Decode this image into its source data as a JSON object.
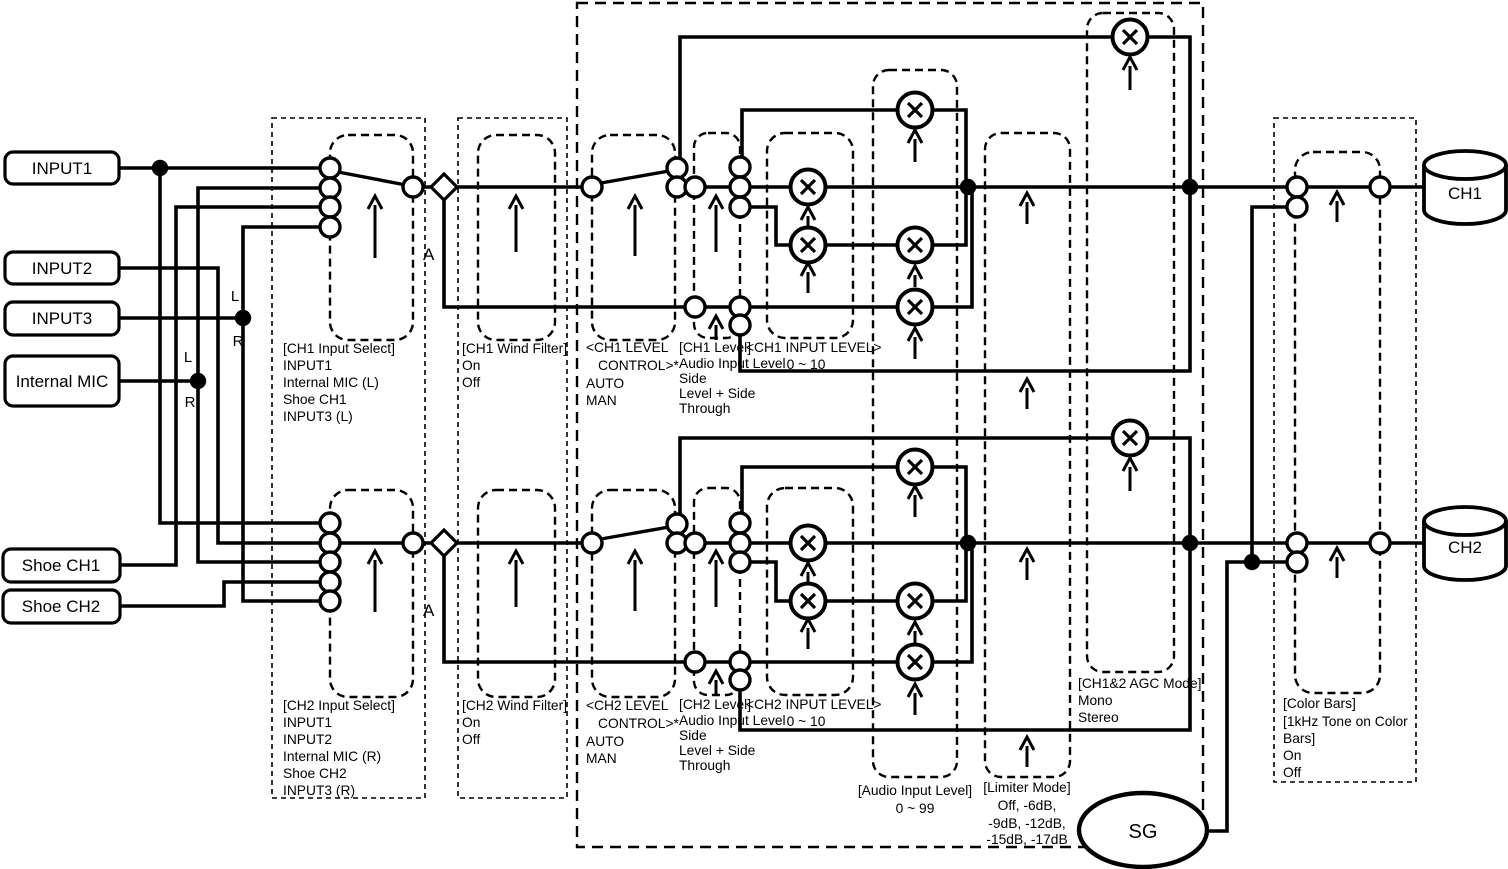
{
  "inputs": {
    "input1": "INPUT1",
    "input2": "INPUT2",
    "input3": "INPUT3",
    "internal_mic": "Internal MIC",
    "shoe_ch1": "Shoe CH1",
    "shoe_ch2": "Shoe CH2"
  },
  "outputs": {
    "ch1": "CH1",
    "ch2": "CH2",
    "sg": "SG"
  },
  "annotations": {
    "a": "A",
    "l": "L",
    "r": "R"
  },
  "blocks": {
    "ch1_input_select": [
      "[CH1 Input Select]",
      "INPUT1",
      "Internal MIC (L)",
      "Shoe CH1",
      "INPUT3 (L)"
    ],
    "ch1_wind_filter": [
      "[CH1 Wind Filter]",
      "On",
      "Off"
    ],
    "ch1_level_control": [
      "<CH1 LEVEL",
      "CONTROL>*",
      "AUTO",
      "MAN"
    ],
    "ch1_level": [
      "[CH1 Level]",
      "Audio Input Level",
      "Side",
      "Level + Side",
      "Through"
    ],
    "ch1_input_level": [
      "<CH1 INPUT LEVEL>",
      "0 ~ 10"
    ],
    "ch2_input_select": [
      "[CH2 Input Select]",
      "INPUT1",
      "INPUT2",
      "Internal MIC (R)",
      "Shoe CH2",
      "INPUT3 (R)"
    ],
    "ch2_wind_filter": [
      "[CH2 Wind Filter]",
      "On",
      "Off"
    ],
    "ch2_level_control": [
      "<CH2 LEVEL",
      "CONTROL>*",
      "AUTO",
      "MAN"
    ],
    "ch2_level": [
      "[CH2 Level]",
      "Audio Input Level",
      "Side",
      "Level + Side",
      "Through"
    ],
    "ch2_input_level": [
      "<CH2 INPUT LEVEL>",
      "0 ~ 10"
    ],
    "audio_input_level": [
      "[Audio Input Level]",
      "0 ~ 99"
    ],
    "limiter_mode": [
      "[Limiter Mode]",
      "Off,  -6dB,",
      "-9dB,  -12dB,",
      "-15dB,  -17dB"
    ],
    "agc_mode": [
      "[CH1&2 AGC Mode]",
      "Mono",
      "Stereo"
    ],
    "color_bars": [
      "[Color Bars]",
      "[1kHz Tone on Color",
      "Bars]",
      "On",
      "Off"
    ]
  }
}
